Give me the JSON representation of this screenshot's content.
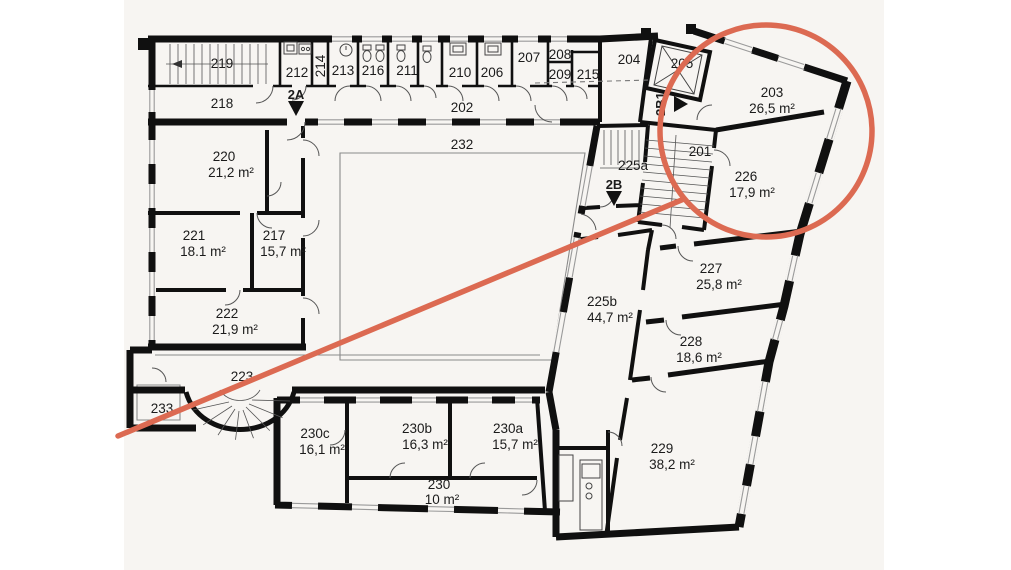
{
  "plan": {
    "rooms": {
      "r201": {
        "number": "201"
      },
      "r202": {
        "number": "202"
      },
      "r203": {
        "number": "203",
        "area": "26,5 m²"
      },
      "r204": {
        "number": "204"
      },
      "r205": {
        "number": "205"
      },
      "r206": {
        "number": "206"
      },
      "r207": {
        "number": "207"
      },
      "r208": {
        "number": "208"
      },
      "r209": {
        "number": "209"
      },
      "r210": {
        "number": "210"
      },
      "r211": {
        "number": "211"
      },
      "r212": {
        "number": "212"
      },
      "r213": {
        "number": "213"
      },
      "r214": {
        "number": "214"
      },
      "r215": {
        "number": "215"
      },
      "r216": {
        "number": "216"
      },
      "r217": {
        "number": "217",
        "area": "15,7 m²"
      },
      "r218": {
        "number": "218"
      },
      "r219": {
        "number": "219"
      },
      "r220": {
        "number": "220",
        "area": "21,2 m²"
      },
      "r221": {
        "number": "221",
        "area": "18.1 m²"
      },
      "r222": {
        "number": "222",
        "area": "21,9 m²"
      },
      "r223": {
        "number": "223"
      },
      "r225a": {
        "number": "225a"
      },
      "r225b": {
        "number": "225b",
        "area": "44,7 m²"
      },
      "r226": {
        "number": "226",
        "area": "17,9 m²"
      },
      "r227": {
        "number": "227",
        "area": "25,8 m²"
      },
      "r228": {
        "number": "228",
        "area": "18,6 m²"
      },
      "r229": {
        "number": "229",
        "area": "38,2 m²"
      },
      "r230": {
        "number": "230",
        "area": "10 m²"
      },
      "r230a": {
        "number": "230a",
        "area": "15,7 m²"
      },
      "r230b": {
        "number": "230b",
        "area": "16,3 m²"
      },
      "r230c": {
        "number": "230c",
        "area": "16,1 m²"
      },
      "r232": {
        "number": "232"
      },
      "r233": {
        "number": "233"
      }
    },
    "markers": {
      "m2a": {
        "label": "2A"
      },
      "m2b": {
        "label": "2B"
      },
      "m2b1": {
        "label": "2B1"
      }
    },
    "annotation": {
      "highlight_color": "#dc6a52",
      "highlighted_rooms": [
        "203",
        "226"
      ]
    },
    "colors": {
      "paper": "#f7f5f2",
      "wall": "#101010"
    }
  }
}
